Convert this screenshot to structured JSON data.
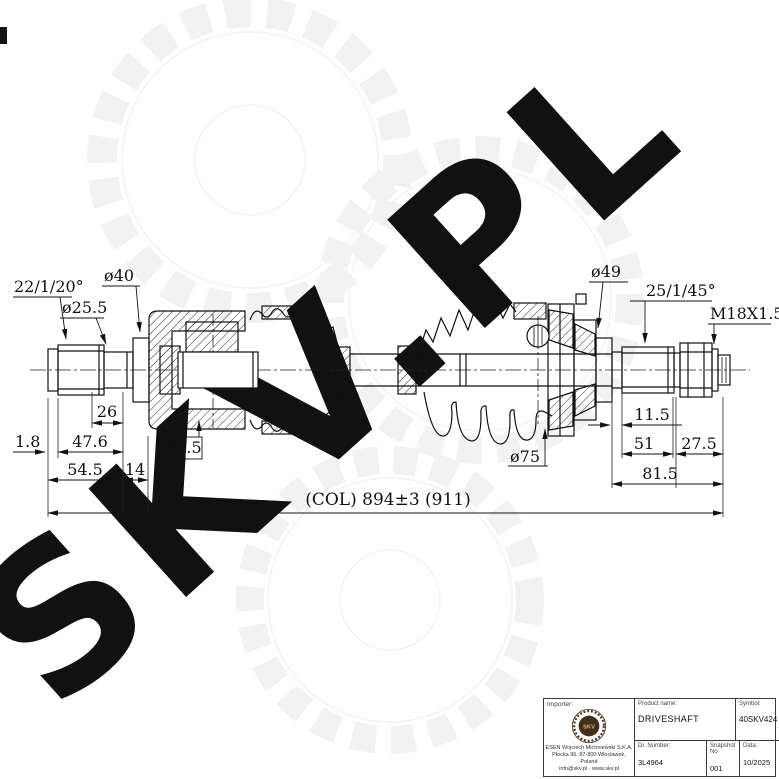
{
  "watermark": {
    "text": "SKV.PL"
  },
  "dims": {
    "angle_left": "22/1/20°",
    "dia_255": "ø25.5",
    "dia_40": "ø40",
    "dia_49": "ø49",
    "angle_right": "25/1/45°",
    "thread": "M18X1.5",
    "len_26": "26",
    "len_18": "1.8",
    "len_476": "47.6",
    "len_545": "54.5",
    "len_14": "14",
    "dia_675": "ø67.5",
    "len_115": "11.5",
    "dia_75": "ø75",
    "len_51": "51",
    "len_275": "27.5",
    "len_815": "81.5",
    "overall": "(COL) 894±3 (911)"
  },
  "title_block": {
    "importer_label": "Importer:",
    "logo_text": "SKV",
    "address_line1": "ESEN Wojciech Michniewski S.K.A.",
    "address_line2": "Płocka 96, 87-800 Włocławek, Poland",
    "address_line3": "info@skv.pl · www.skv.pl",
    "product_label": "Product name:",
    "product_value": "DRIVESHAFT",
    "symbol_label": "Symbol:",
    "symbol_value": "40SKV424",
    "number_label": "Dr. Number:",
    "number_value": "3L4964",
    "sheet_label": "Snapshot No",
    "sheet_value": "001",
    "date_label": "Data:",
    "date_value": "10/2025"
  }
}
